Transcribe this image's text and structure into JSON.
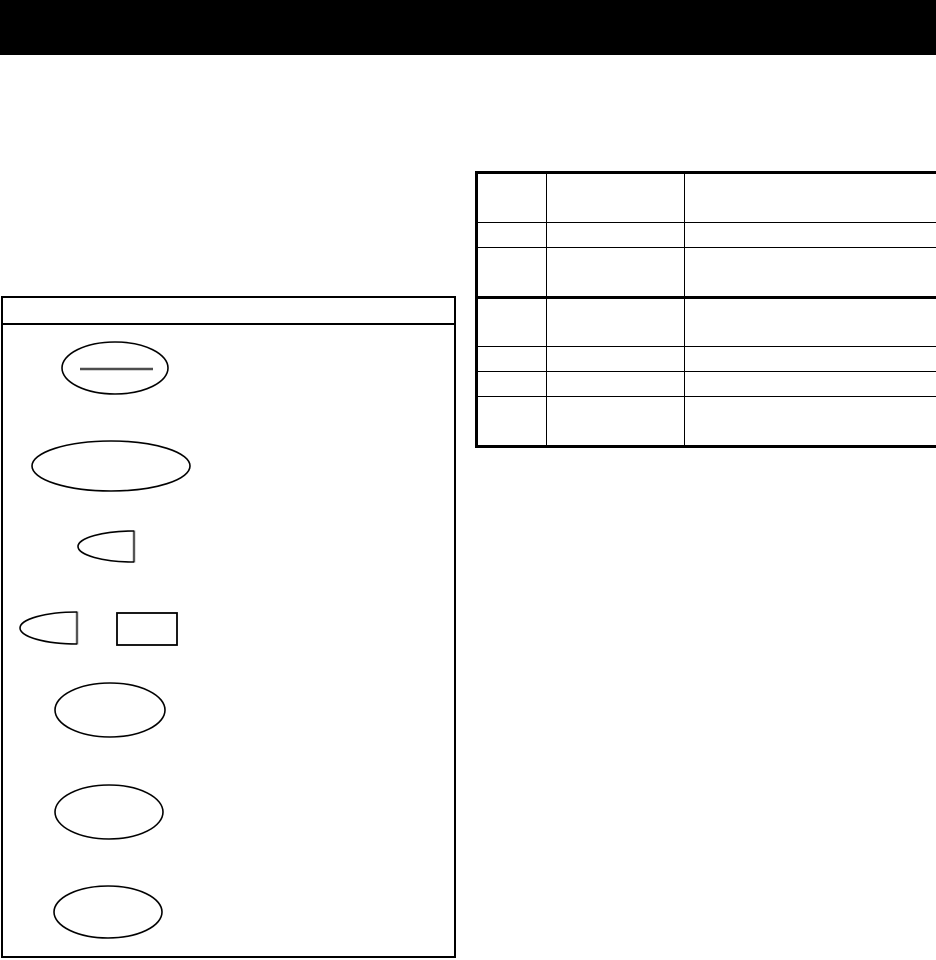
{
  "page": {
    "background_color": "#ffffff"
  },
  "header_bar": {
    "color": "#000000",
    "height": 55
  },
  "reference_table": {
    "rows": 7,
    "columns": 3,
    "column_widths": [
      68,
      137,
      255
    ],
    "thick_divider_after_row": 3,
    "border_color": "#000000",
    "cells_visible_text": "",
    "note_all_cells_empty": true
  },
  "symbol_panel": {
    "border_color": "#000000",
    "title_visible_text": "",
    "shapes": [
      {
        "kind": "ellipse",
        "name": "ellipse-with-bar-symbol",
        "cx": 115,
        "cy": 368,
        "rx": 53,
        "ry": 26,
        "color": "#000000",
        "width": 1.6
      },
      {
        "kind": "line",
        "name": "gray-bar-inside-ellipse",
        "x1": 80,
        "y1": 369,
        "x2": 153,
        "y2": 369,
        "color": "#4d4d4d",
        "width": 2.6
      },
      {
        "kind": "ellipse",
        "name": "wide-flat-ellipse-symbol",
        "cx": 111,
        "cy": 466,
        "rx": 79,
        "ry": 25,
        "color": "#000000",
        "width": 1.6
      },
      {
        "kind": "half_ellipse",
        "name": "half-ellipse-symbol-small",
        "x": 78,
        "y": 531,
        "w": 56,
        "h": 31,
        "color": "#000000",
        "width": 1.6,
        "edge_color": "#555555",
        "edge_width": 2.4
      },
      {
        "kind": "half_ellipse",
        "name": "half-ellipse-symbol",
        "x": 20,
        "y": 612,
        "w": 57,
        "h": 32,
        "color": "#000000",
        "width": 1.6,
        "edge_color": "#555555",
        "edge_width": 2.4
      },
      {
        "kind": "rect",
        "name": "rectangle-symbol",
        "x": 117,
        "y": 613,
        "w": 60,
        "h": 32,
        "color": "#000000",
        "width": 1.8
      },
      {
        "kind": "ellipse",
        "name": "ellipse-symbol-1",
        "cx": 110,
        "cy": 710,
        "rx": 55,
        "ry": 27,
        "color": "#000000",
        "width": 1.6
      },
      {
        "kind": "ellipse",
        "name": "ellipse-symbol-2",
        "cx": 109,
        "cy": 812,
        "rx": 54,
        "ry": 27,
        "color": "#000000",
        "width": 1.6
      },
      {
        "kind": "ellipse",
        "name": "ellipse-symbol-3",
        "cx": 108,
        "cy": 912,
        "rx": 54,
        "ry": 26,
        "color": "#000000",
        "width": 1.6
      }
    ]
  }
}
